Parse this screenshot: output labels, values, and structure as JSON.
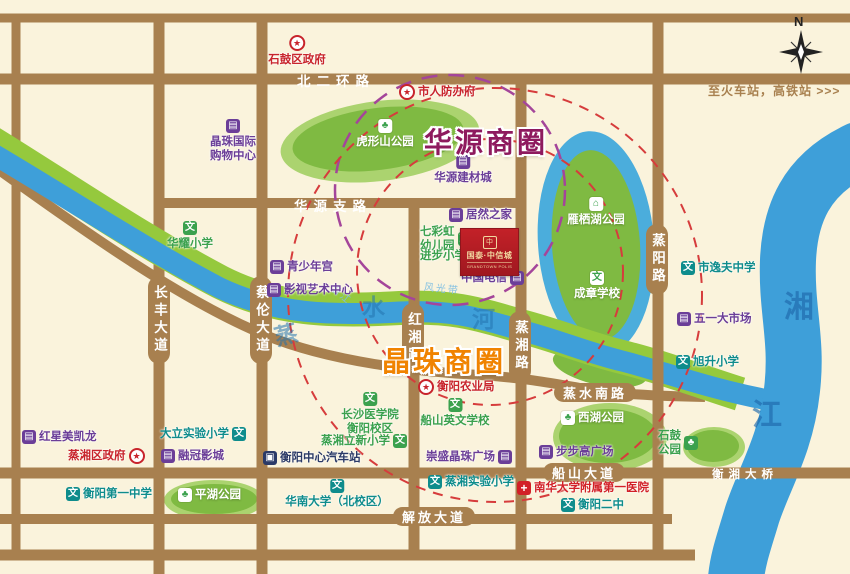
{
  "map": {
    "compass_n": "N",
    "direction_note": "至火车站，高铁站 >>>",
    "business_circles": [
      {
        "name": "华源商圈",
        "color": "#8E1A5E",
        "x": 424,
        "y": 121
      },
      {
        "name": "晶珠商圈",
        "color": "#F08300",
        "x": 382,
        "y": 340
      }
    ],
    "project": {
      "name": "国泰·中信城",
      "subtitle": "GRANDTOWN POLIS",
      "logo_char": "中"
    },
    "colors": {
      "background": "#FAF3DC",
      "road": "#A8804F",
      "river": "#3E9FD9",
      "park": "#7FBA42",
      "gov_red": "#C8242C",
      "biz_purple": "#6B3E98",
      "school_green": "#3BA14E",
      "school_teal": "#0E8C8C",
      "hospital_red": "#D22027",
      "bus_navy": "#2B3A67",
      "circle_purple": "#8E1A5E",
      "circle_orange": "#F08300",
      "project_red": "#BE1A22",
      "gold": "#F1D7A0"
    },
    "roads": {
      "labels": [
        {
          "id": "beierhuan-road",
          "name": "北二环路",
          "kind": "plain-h",
          "x": 297,
          "y": 70
        },
        {
          "id": "huayuan-branch-road",
          "name": "华源支路",
          "kind": "plain-h",
          "x": 294,
          "y": 195
        },
        {
          "id": "changfeng-avenue",
          "name": "长丰大道",
          "kind": "cap-v",
          "x": 148,
          "y": 276
        },
        {
          "id": "cailun-avenue",
          "name": "蔡伦大道",
          "kind": "cap-v",
          "x": 250,
          "y": 276
        },
        {
          "id": "hongxiang-road",
          "name": "红湘路",
          "kind": "cap-v",
          "x": 402,
          "y": 303
        },
        {
          "id": "zhengxiang-road",
          "name": "蒸湘路",
          "kind": "cap-v",
          "x": 509,
          "y": 311
        },
        {
          "id": "zhengyang-road",
          "name": "蒸阳路",
          "kind": "cap-v",
          "x": 646,
          "y": 224
        },
        {
          "id": "zhengshui-south-road",
          "name": "蒸水南路",
          "kind": "cap-h",
          "x": 554,
          "y": 383
        },
        {
          "id": "chuanshan-avenue",
          "name": "船山大道",
          "kind": "cap-h",
          "x": 543,
          "y": 463
        },
        {
          "id": "jiefang-avenue",
          "name": "解放大道",
          "kind": "cap-h",
          "x": 393,
          "y": 507
        },
        {
          "id": "hengxiang-bridge",
          "name": "衡湘大桥",
          "kind": "plain-h-sm",
          "x": 712,
          "y": 466
        }
      ]
    },
    "rivers": {
      "zhengshui_chars": [
        {
          "t": "蒸",
          "x": 274,
          "y": 316,
          "rot": -15
        },
        {
          "t": "水",
          "x": 362,
          "y": 288,
          "rot": 0
        },
        {
          "t": "河",
          "x": 472,
          "y": 300,
          "rot": 0
        }
      ],
      "xiangjiang_chars": [
        {
          "t": "湘",
          "x": 784,
          "y": 282,
          "rot": 0
        },
        {
          "t": "江",
          "x": 752,
          "y": 390,
          "rot": 0
        }
      ],
      "scenic_belt": [
        {
          "t": "沿江",
          "x": 330,
          "y": 286,
          "rot": 40
        },
        {
          "t": "风光带",
          "x": 424,
          "y": 280,
          "rot": 6
        }
      ]
    },
    "pois": [
      {
        "id": "shigu-district-gov",
        "label": "石鼓区政府",
        "type": "gov",
        "iconPos": "top",
        "anchor": "center",
        "x": 297,
        "y": 35
      },
      {
        "id": "civil-defense-office",
        "label": "市人防办府",
        "type": "gov",
        "iconPos": "left",
        "x": 399,
        "y": 84
      },
      {
        "id": "jingzhu-intl-mall",
        "label": [
          "晶珠国际",
          "购物中心"
        ],
        "type": "biz",
        "iconPos": "top",
        "anchor": "center",
        "x": 233,
        "y": 119
      },
      {
        "id": "huxingshan-park",
        "label": "虎形山公园",
        "type": "park",
        "iconPos": "top",
        "anchor": "center",
        "x": 385,
        "y": 119
      },
      {
        "id": "huayuan-building-materials",
        "label": "华源建材城",
        "type": "biz",
        "iconPos": "top",
        "anchor": "center",
        "x": 463,
        "y": 155
      },
      {
        "id": "yanqihu-park",
        "label": "雁栖湖公园",
        "type": "pavilion",
        "iconPos": "top",
        "anchor": "center",
        "x": 596,
        "y": 197
      },
      {
        "id": "chengzhang-school",
        "label": "成章学校",
        "type": "wen-white",
        "iconPos": "top",
        "anchor": "center",
        "x": 597,
        "y": 271
      },
      {
        "id": "huayao-primary",
        "label": "华耀小学",
        "type": "school-g",
        "iconPos": "top",
        "anchor": "center",
        "x": 190,
        "y": 221
      },
      {
        "id": "juranzhijia",
        "label": "居然之家",
        "type": "biz",
        "iconPos": "left",
        "x": 449,
        "y": 208
      },
      {
        "id": "qicaihong-kindergarten",
        "label": [
          "七彩虹",
          "幼儿园"
        ],
        "type": "school-g",
        "iconPos": "right",
        "x": 420,
        "y": 225
      },
      {
        "id": "jinbu-primary",
        "label": "进步小学",
        "type": "school-g",
        "iconPos": "right",
        "x": 420,
        "y": 249
      },
      {
        "id": "china-telecom",
        "label": "中国电信",
        "type": "biz",
        "iconPos": "right",
        "x": 461,
        "y": 271
      },
      {
        "id": "yifu-middle-school",
        "label": "市逸夫中学",
        "type": "school-t",
        "iconPos": "left",
        "x": 681,
        "y": 261
      },
      {
        "id": "wuyi-market",
        "label": "五一大市场",
        "type": "biz",
        "iconPos": "left",
        "x": 677,
        "y": 312
      },
      {
        "id": "xusheng-primary",
        "label": "旭升小学",
        "type": "school-t",
        "iconPos": "left",
        "x": 676,
        "y": 355
      },
      {
        "id": "youth-palace",
        "label": "青少年宫",
        "type": "biz",
        "iconPos": "left",
        "x": 270,
        "y": 260
      },
      {
        "id": "film-art-center",
        "label": "影视艺术中心",
        "type": "biz",
        "iconPos": "left",
        "x": 267,
        "y": 283
      },
      {
        "id": "hengyang-agriculture-bureau",
        "label": "衡阳农业局",
        "type": "gov",
        "iconPos": "left",
        "x": 418,
        "y": 379
      },
      {
        "id": "xihu-park",
        "label": "西湖公园",
        "type": "park",
        "iconPos": "left",
        "x": 561,
        "y": 411
      },
      {
        "id": "changsha-medical-college",
        "label": [
          "长沙医学院",
          "衡阳校区"
        ],
        "type": "school-g",
        "iconPos": "top",
        "anchor": "center",
        "x": 370,
        "y": 392
      },
      {
        "id": "chuanshan-english-school",
        "label": "船山英文学校",
        "type": "school-g",
        "iconPos": "top",
        "anchor": "center",
        "x": 455,
        "y": 398
      },
      {
        "id": "zhengxiang-lixin-primary",
        "label": "蒸湘立新小学",
        "type": "school-g",
        "iconPos": "right",
        "x": 321,
        "y": 434
      },
      {
        "id": "central-bus-station",
        "label": "衡阳中心汽车站",
        "type": "bus",
        "iconPos": "left",
        "x": 263,
        "y": 451
      },
      {
        "id": "chongsheng-jingzhu-plaza",
        "label": "崇盛晶珠广场",
        "type": "biz",
        "iconPos": "right",
        "x": 426,
        "y": 450
      },
      {
        "id": "zhengxiang-experimental-primary",
        "label": "蒸湘实验小学",
        "type": "school-t",
        "iconPos": "left",
        "x": 428,
        "y": 475
      },
      {
        "id": "bubugao-plaza",
        "label": "步步高广场",
        "type": "biz",
        "iconPos": "left",
        "x": 539,
        "y": 445
      },
      {
        "id": "nanhua-univ-first-hospital",
        "label": "南华大学附属第一医院",
        "type": "hospital",
        "iconPos": "left",
        "x": 517,
        "y": 481
      },
      {
        "id": "hengyang-no2-middle",
        "label": "衡阳二中",
        "type": "school-t",
        "iconPos": "left",
        "x": 561,
        "y": 498
      },
      {
        "id": "shigu-park",
        "label": [
          "石鼓",
          "公园"
        ],
        "type": "park-green",
        "iconPos": "right",
        "x": 658,
        "y": 429
      },
      {
        "id": "redstar-macalline",
        "label": "红星美凯龙",
        "type": "biz",
        "iconPos": "left",
        "x": 22,
        "y": 430
      },
      {
        "id": "zhengxiang-district-gov",
        "label": "蒸湘区政府",
        "type": "gov",
        "iconPos": "right",
        "x": 68,
        "y": 448
      },
      {
        "id": "dali-experimental-primary",
        "label": "大立实验小学",
        "type": "school-t",
        "iconPos": "right",
        "x": 160,
        "y": 427
      },
      {
        "id": "rongguan-cinema",
        "label": "融冠影城",
        "type": "biz",
        "iconPos": "left",
        "x": 161,
        "y": 449
      },
      {
        "id": "hengyang-no1-high",
        "label": "衡阳第一中学",
        "type": "school-t",
        "iconPos": "left",
        "x": 66,
        "y": 487
      },
      {
        "id": "pinghu-park",
        "label": "平湖公园",
        "type": "park",
        "iconPos": "left",
        "x": 178,
        "y": 488
      },
      {
        "id": "huanan-univ-north-campus",
        "label": "华南大学（北校区）",
        "type": "school-t",
        "iconPos": "top",
        "anchor": "center",
        "x": 337,
        "y": 479
      }
    ]
  }
}
